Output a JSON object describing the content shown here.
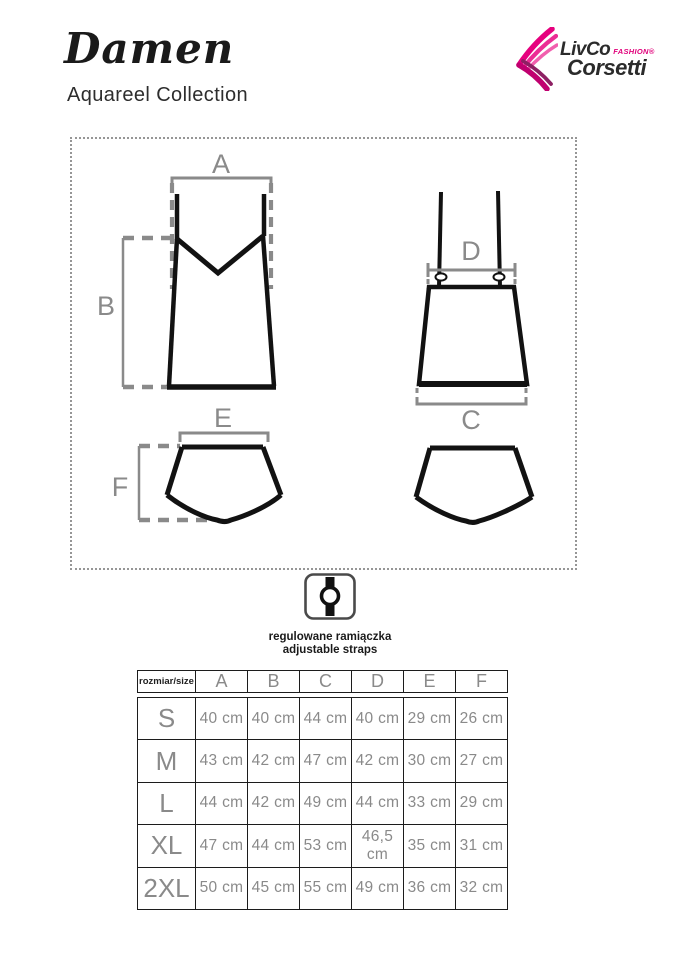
{
  "header": {
    "title": "Damen",
    "subtitle": "Aquareel Collection"
  },
  "logo": {
    "brand_top": "LivCo",
    "brand_tag": "FASHION®",
    "brand_bottom": "Corsetti",
    "accent_color": "#e0007a"
  },
  "diagram": {
    "labels": {
      "a": "A",
      "b": "B",
      "c": "C",
      "d": "D",
      "e": "E",
      "f": "F"
    }
  },
  "straps_note": {
    "line_pl": "regulowane ramiączka",
    "line_en": "adjustable straps"
  },
  "size_table": {
    "corner_label": "rozmiar/size",
    "columns": [
      "A",
      "B",
      "C",
      "D",
      "E",
      "F"
    ],
    "rows": [
      {
        "size": "S",
        "values": [
          "40 cm",
          "40 cm",
          "44 cm",
          "40 cm",
          "29 cm",
          "26 cm"
        ]
      },
      {
        "size": "M",
        "values": [
          "43 cm",
          "42 cm",
          "47 cm",
          "42 cm",
          "30 cm",
          "27 cm"
        ]
      },
      {
        "size": "L",
        "values": [
          "44 cm",
          "42 cm",
          "49 cm",
          "44 cm",
          "33 cm",
          "29 cm"
        ]
      },
      {
        "size": "XL",
        "values": [
          "47 cm",
          "44 cm",
          "53 cm",
          "46,5 cm",
          "35 cm",
          "31 cm"
        ]
      },
      {
        "size": "2XL",
        "values": [
          "50 cm",
          "45 cm",
          "55 cm",
          "49 cm",
          "36 cm",
          "32 cm"
        ]
      }
    ]
  }
}
